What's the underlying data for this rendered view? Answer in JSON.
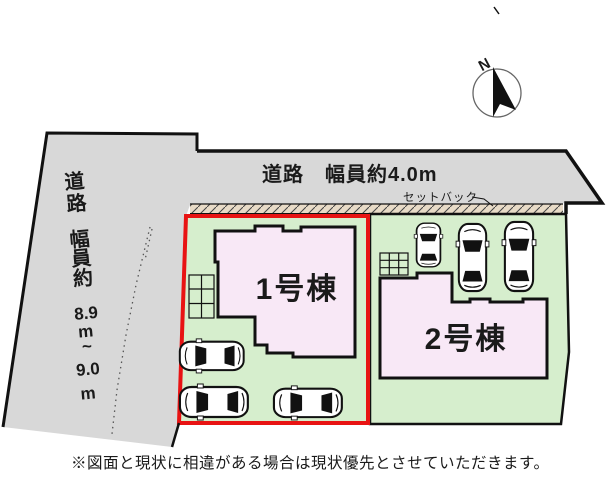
{
  "plan": {
    "north": {
      "label": "N"
    },
    "roads": {
      "top": {
        "label": "道路　幅員約4.0m"
      },
      "left": {
        "label_lines": [
          "道",
          "路",
          "幅",
          "員",
          "約",
          "8.9",
          "m",
          "~",
          "9.0",
          "m"
        ]
      }
    },
    "setback": {
      "label": "セットバック"
    },
    "buildings": [
      {
        "label": "1号棟"
      },
      {
        "label": "2号棟"
      }
    ],
    "parking": {
      "lot1_cars": 3,
      "lot2_cars": 3
    },
    "disclaimer": "※図面と現状に相違がある場合は現状優先とさせていただきます。"
  },
  "colors": {
    "road_gray": "#d8d8d8",
    "lot_green": "#d6eecd",
    "building_pink": "#f8e8f6",
    "setback_beige": "#e8dbc7",
    "lot1_outline_red": "#e81313",
    "line_black": "#111111"
  }
}
